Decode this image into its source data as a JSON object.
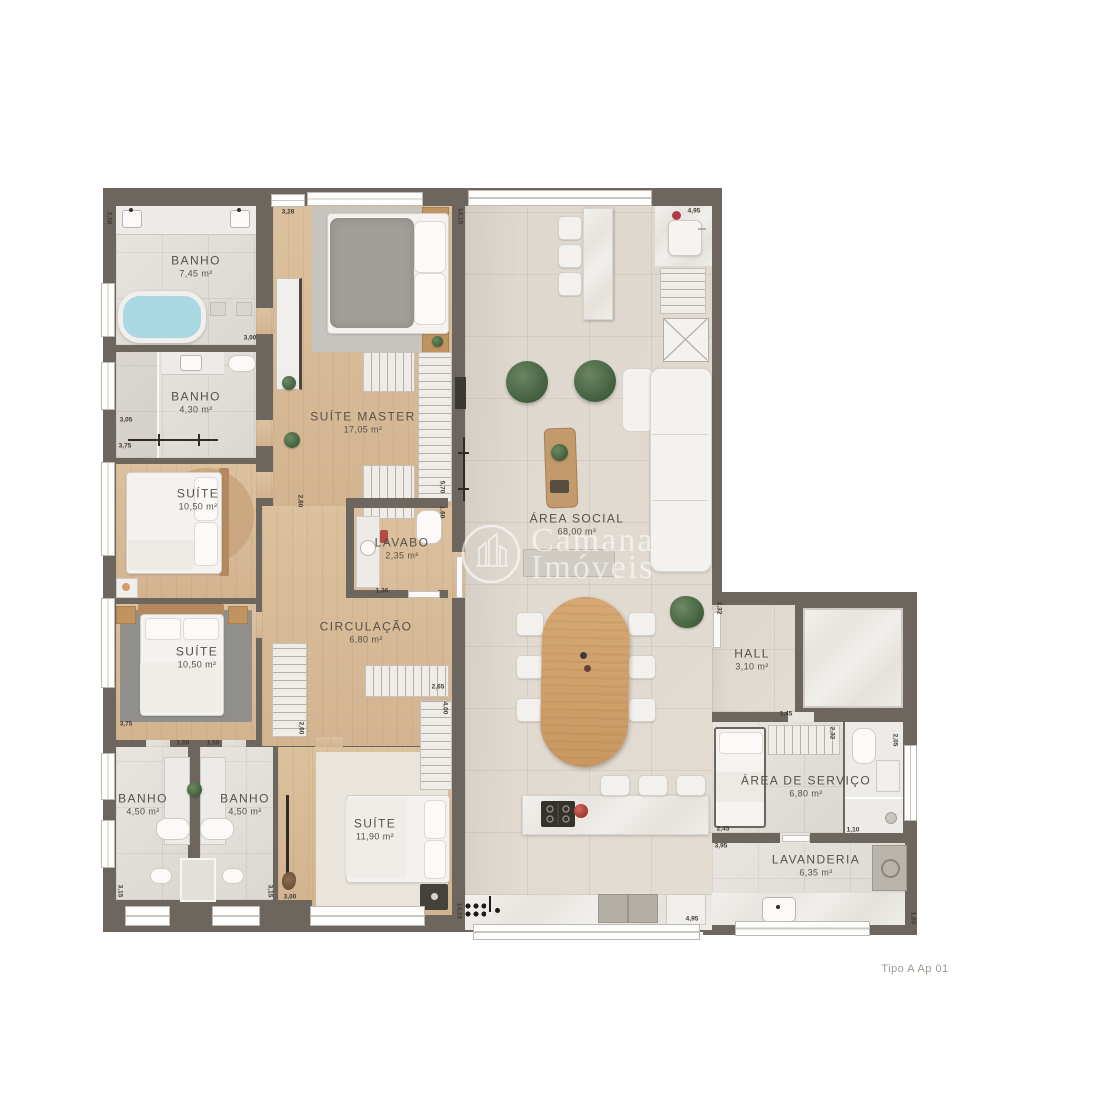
{
  "plan_title": "Tipo A Ap 01",
  "watermark": {
    "line1": "Camana",
    "line2": "Imóveis",
    "logo": "buildings-in-circle-icon"
  },
  "rooms": [
    {
      "name": "BANHO",
      "area": "7,45 m²"
    },
    {
      "name": "BANHO",
      "area": "4,30 m²"
    },
    {
      "name": "SUÍTE",
      "area": "10,50 m²"
    },
    {
      "name": "SUÍTE MASTER",
      "area": "17,05 m²"
    },
    {
      "name": "LAVABO",
      "area": "2,35 m²"
    },
    {
      "name": "CIRCULAÇÃO",
      "area": "6,80 m²"
    },
    {
      "name": "SUÍTE",
      "area": "10,50 m²"
    },
    {
      "name": "BANHO",
      "area": "4,50 m²"
    },
    {
      "name": "BANHO",
      "area": "4,50 m²"
    },
    {
      "name": "SUÍTE",
      "area": "11,90 m²"
    },
    {
      "name": "ÁREA SOCIAL",
      "area": "68,00 m²"
    },
    {
      "name": "HALL",
      "area": "3,10 m²"
    },
    {
      "name": "ÁREA DE SERVIÇO",
      "area": "6,80 m²"
    },
    {
      "name": "LAVANDERIA",
      "area": "6,35 m²"
    }
  ],
  "dims": [
    "2,50",
    "3,28",
    "3,00",
    "3,05",
    "3,75",
    "3,75",
    "1,50",
    "1,50",
    "3,15",
    "3,15",
    "3,00",
    "2,60",
    "2,60",
    "1,36",
    "5,70",
    "1,60",
    "2,65",
    "4,00",
    "14,15",
    "14,15",
    "4,95",
    "4,95",
    "2,32",
    "2,32",
    "1,45",
    "2,05",
    "1,10",
    "2,45",
    "3,95",
    "1,65"
  ],
  "colors": {
    "wall": "#6c665e",
    "wood_floor": "#d7bd9a",
    "social_tile": "#ddd7ce",
    "bath_tile": "#e4e1dc",
    "tub_water": "#a9d8e3",
    "plant_green": "#4e6d49",
    "accent_red": "#bf4a42",
    "label_text": "#55504a"
  }
}
